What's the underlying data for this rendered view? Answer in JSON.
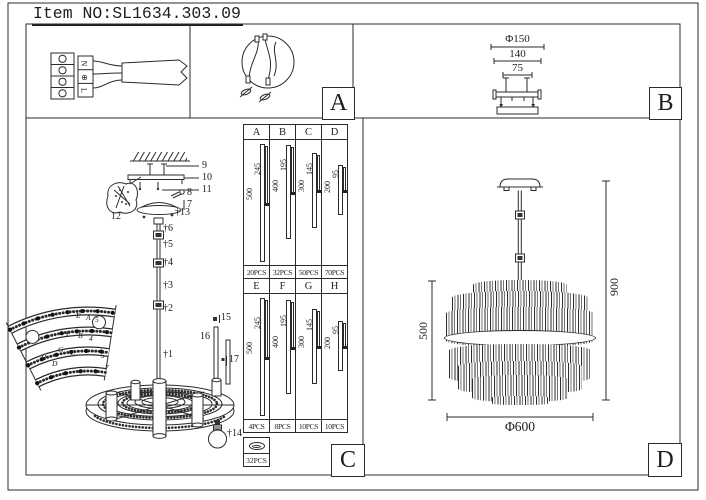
{
  "title": "Item NO:SL1634.303.09",
  "panel_labels": {
    "a": "A",
    "b": "B",
    "c": "C",
    "d": "D"
  },
  "wiring": {
    "neutral": "N",
    "earth": "⊕",
    "live": "L"
  },
  "bracket": {
    "dia": "Φ150",
    "width": "140",
    "inner": "75"
  },
  "exploded": {
    "p1": "†1",
    "p2": "†2",
    "p3": "†3",
    "p4": "†4",
    "p5": "†5",
    "p6": "†6",
    "p7": "7",
    "p8": "8",
    "p9": "9",
    "p10": "10",
    "p11": "11",
    "p12": "12",
    "p13": "†13",
    "p14": "†14",
    "p15": "15",
    "p16": "16",
    "p17": "17"
  },
  "fan": {
    "rows": [
      {
        "left": "E",
        "mid": "A",
        "num": "5"
      },
      {
        "left": "F",
        "mid": "B",
        "num": "4"
      },
      {
        "left": "G",
        "mid": "C",
        "num": "5"
      },
      {
        "left": "H",
        "mid": "D",
        "num": "7"
      }
    ]
  },
  "rod_table": {
    "top": {
      "headers": [
        "A",
        "B",
        "C",
        "D"
      ],
      "outer": [
        "500",
        "400",
        "300",
        "200"
      ],
      "inner": [
        "245",
        "195",
        "145",
        "95"
      ],
      "qty": [
        "20PCS",
        "32PCS",
        "50PCS",
        "70PCS"
      ]
    },
    "bottom": {
      "headers": [
        "E",
        "F",
        "G",
        "H"
      ],
      "outer": [
        "500",
        "400",
        "300",
        "200"
      ],
      "inner": [
        "245",
        "195",
        "145",
        "95"
      ],
      "qty": [
        "4PCS",
        "8PCS",
        "10PCS",
        "10PCS"
      ]
    },
    "ring_qty": "32PCS"
  },
  "overall": {
    "body_height": "500",
    "total_height": "900",
    "diameter": "Φ600"
  }
}
